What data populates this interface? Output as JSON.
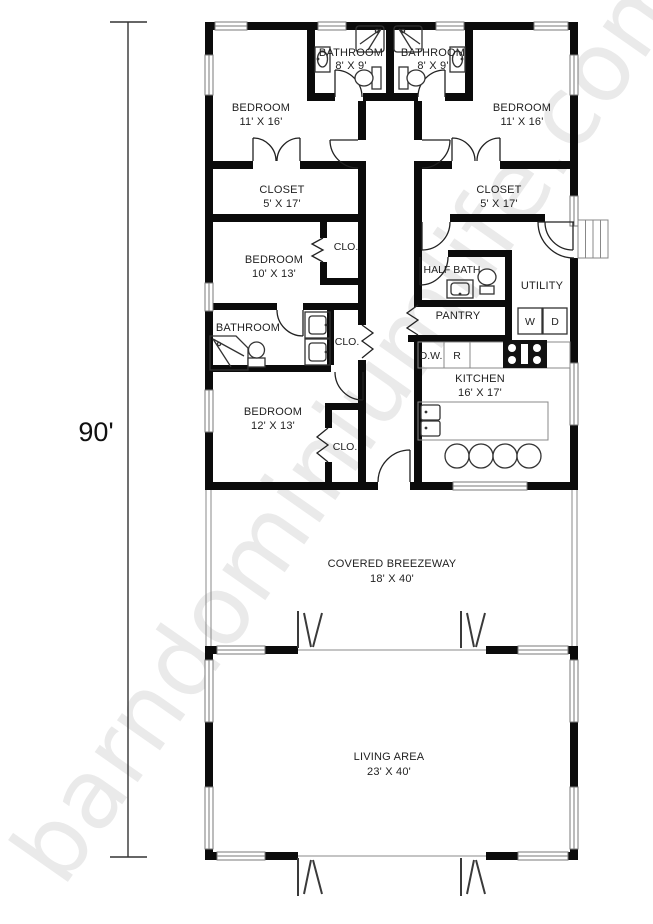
{
  "watermark": "barndominiumlife.com",
  "dimension_label": "90'",
  "rooms": {
    "bathroom_top_left": {
      "name": "BATHROOM",
      "dims": "8' X 9'"
    },
    "bathroom_top_right": {
      "name": "BATHROOM",
      "dims": "8' X 9'"
    },
    "bedroom_top_left": {
      "name": "BEDROOM",
      "dims": "11' X 16'"
    },
    "bedroom_top_right": {
      "name": "BEDROOM",
      "dims": "11' X 16'"
    },
    "closet_left": {
      "name": "CLOSET",
      "dims": "5' X 17'"
    },
    "closet_right": {
      "name": "CLOSET",
      "dims": "5' X 17'"
    },
    "bedroom_middle": {
      "name": "BEDROOM",
      "dims": "10' X 13'"
    },
    "closet_small_1": {
      "name": "CLO."
    },
    "closet_small_2": {
      "name": "CLO."
    },
    "closet_small_3": {
      "name": "CLO."
    },
    "half_bath": {
      "name": "HALF BATH"
    },
    "utility": {
      "name": "UTILITY"
    },
    "pantry": {
      "name": "PANTRY"
    },
    "bathroom_lower": {
      "name": "BATHROOM"
    },
    "bedroom_lower": {
      "name": "BEDROOM",
      "dims": "12' X 13'"
    },
    "kitchen": {
      "name": "KITCHEN",
      "dims": "16' X 17'"
    },
    "breezeway": {
      "name": "COVERED BREEZEWAY",
      "dims": "18' X 40'"
    },
    "living_area": {
      "name": "LIVING AREA",
      "dims": "23' X 40'"
    }
  },
  "appliances": {
    "washer": "W",
    "dryer": "D",
    "dishwasher": "D.W.",
    "range": "R"
  },
  "colors": {
    "wall": "#0b0b0b",
    "watermark": "#eaeaea",
    "text": "#1f1f1f"
  }
}
